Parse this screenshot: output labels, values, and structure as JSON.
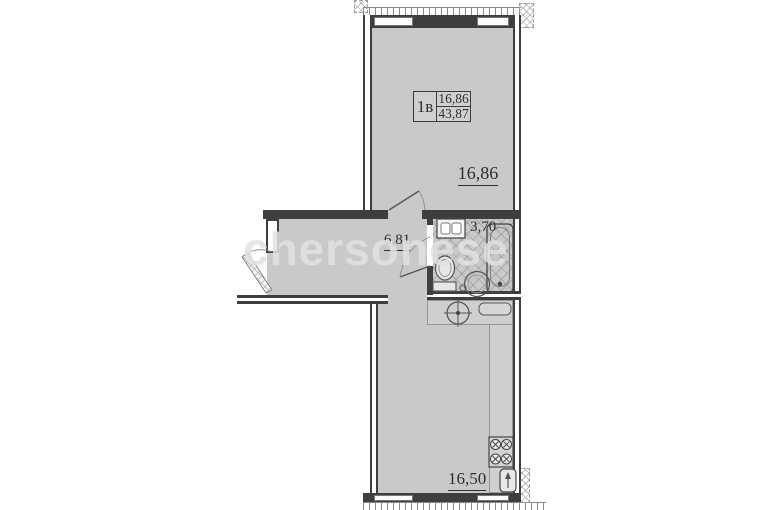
{
  "watermark": {
    "text": "chersonese"
  },
  "unit_card": {
    "type_label": "1в",
    "living_area": "16,86",
    "total_area": "43,87"
  },
  "rooms": {
    "living": {
      "name": "living-room",
      "area": "16,86"
    },
    "hallway": {
      "name": "hallway",
      "area": "6,81"
    },
    "bathroom": {
      "name": "bathroom",
      "area": "3,70"
    },
    "kitchen": {
      "name": "kitchen",
      "area": "16,50"
    }
  },
  "icons": {
    "washing_machine": "box with two door squares",
    "bathtub": "rounded tub with drain",
    "toilet": "bowl with tank",
    "washbasin": "round basin",
    "floor_drain": "small circle",
    "kitchen_sink_round": "circle with crosshair",
    "drainboard": "rounded tray",
    "stove": "four burners with x marks",
    "corner_sink": "rounded square with tap",
    "entrance_door": "hatched leaf with swing arc",
    "interior_door": "leaf line with swing arc"
  },
  "colors": {
    "wall": "#3e3e3e",
    "floor": "#c9c9c9",
    "counter": "#cfcfcf",
    "label": "#2f2f2f",
    "watermark": "#e2e2e2"
  }
}
